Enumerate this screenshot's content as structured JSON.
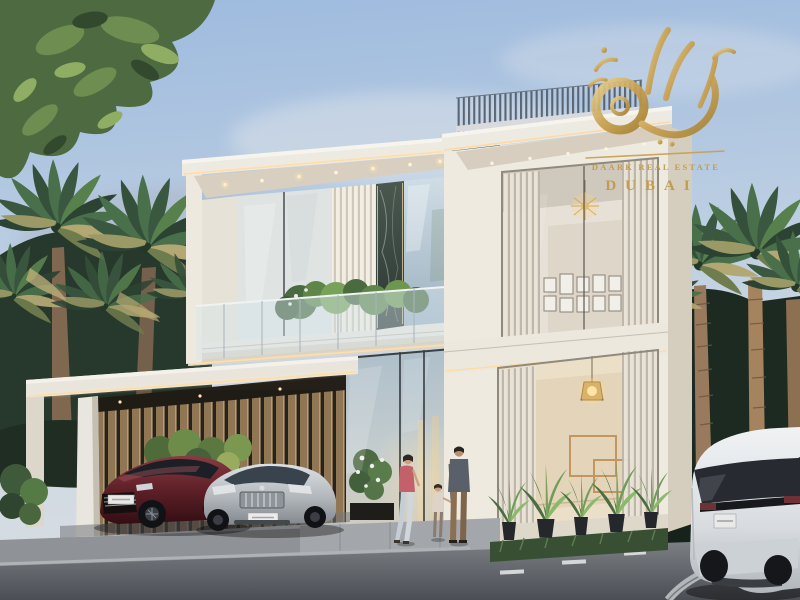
{
  "scene": {
    "kind": "architectural-exterior-render",
    "subject": "Modern two-storey luxury villa at dusk with palm trees, carport with two sedans, white SUV at right kerb and a family of three at the glass entrance"
  },
  "watermark": {
    "line1": "DAARK REAL ESTATE",
    "line2": "DUBAI",
    "gold": "#c6a050"
  },
  "palette": {
    "sky_top": "#9dbade",
    "sky_haze": "#d9dde1",
    "facade_white": "#ece9e1",
    "facade_cream": "#ded6c8",
    "warm_led": "#ffd9a0",
    "marble_dark": "#3f4b45",
    "glass_blue": "#b7c6cf",
    "palm_green": "#3a5740",
    "asphalt": "#5e6166",
    "car_maroon": "#5e2028",
    "car_silver": "#b2b7bc",
    "car_white": "#e6e9ec"
  },
  "objects": {
    "vehicles": [
      "maroon-sedan",
      "silver-sedan",
      "white-suv"
    ],
    "people": [
      "woman",
      "child",
      "man"
    ],
    "vegetation": [
      "overhanging-tree",
      "palm-grove-left",
      "palm-grove-right",
      "balcony-plants",
      "agave-planters",
      "grass-strip"
    ],
    "architecture": [
      "roof-fin-parapet",
      "carport",
      "glass-entrance",
      "marble-piers",
      "louver-screens",
      "chandelier",
      "pendant-lamp",
      "gallery-frames",
      "gold-wall-art"
    ]
  }
}
